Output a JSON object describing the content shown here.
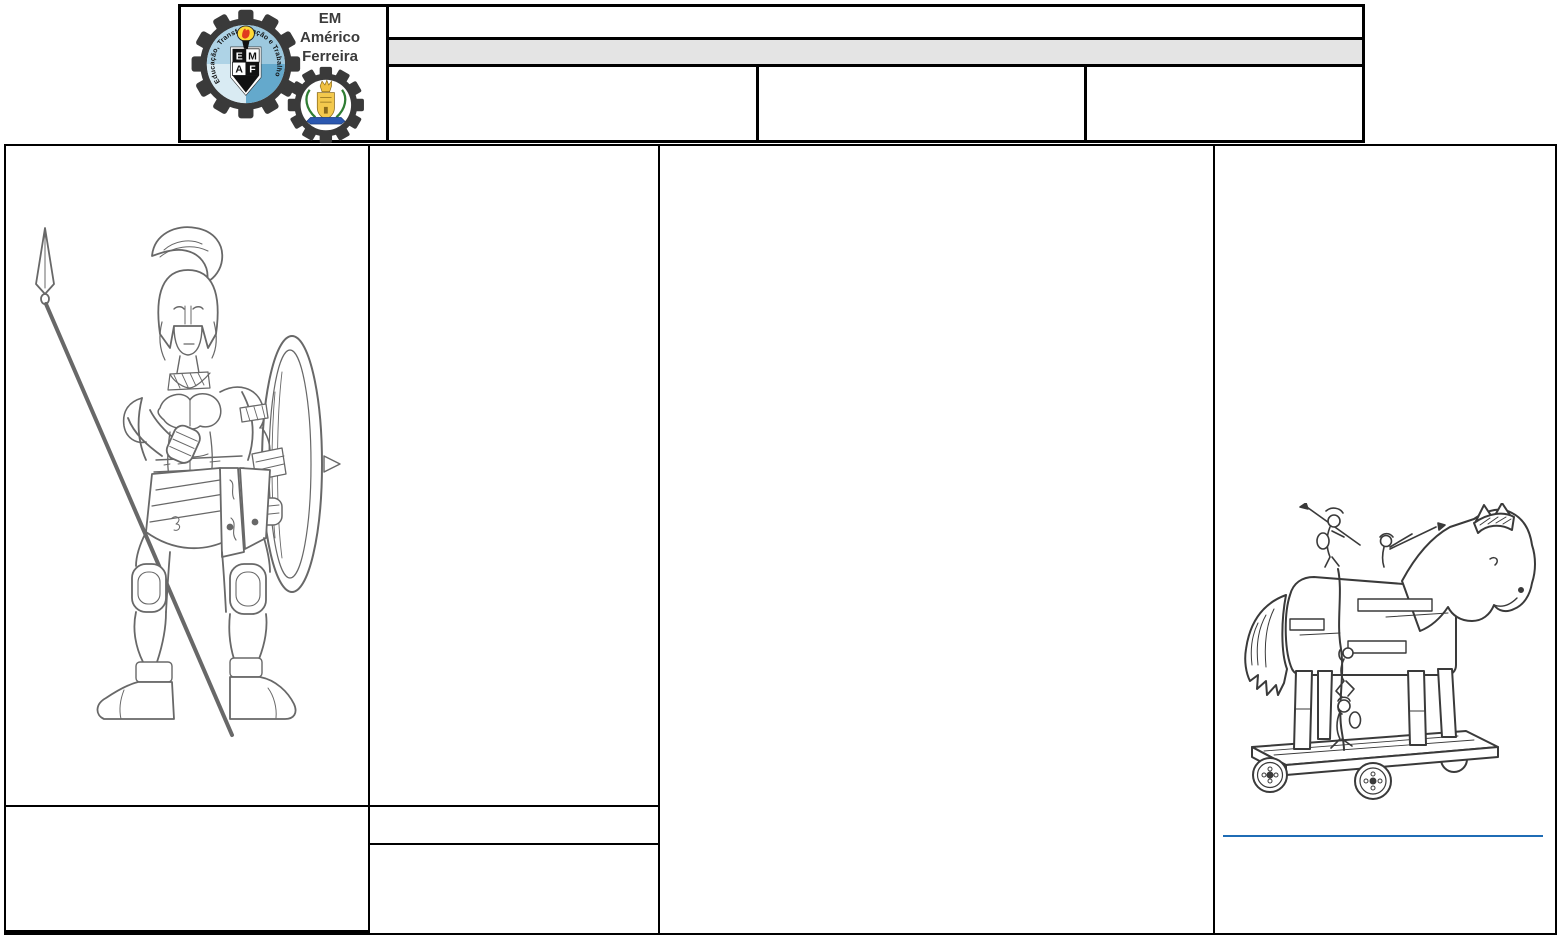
{
  "header": {
    "logo": {
      "title_line1": "EM",
      "title_line2": "Américo",
      "title_line3": "Ferreira",
      "motto": "Educação, Transformação e Trabalho",
      "emblem_letters": [
        "E",
        "M",
        "A",
        "F"
      ]
    },
    "row1_text": "",
    "banner_text": "",
    "cells": [
      "",
      "",
      ""
    ]
  },
  "main_table": {
    "warrior_cell_text": "",
    "left_bottom_text": "",
    "col2_top_text": "",
    "col2_mid_text": "",
    "col2_bottom_text": "",
    "col3_text": "",
    "col4_text": ""
  },
  "illustrations": {
    "warrior": "greek-hoplite-warrior-line-drawing",
    "trojan_horse": "trojan-horse-on-wheels-line-drawing"
  },
  "colors": {
    "banner_gray": "#e4e4e4",
    "table_border": "#000000",
    "link_line_blue": "#1f6cb5",
    "logo_dark_gray": "#3a3a3a",
    "logo_light_blue": "#9cc8de"
  }
}
